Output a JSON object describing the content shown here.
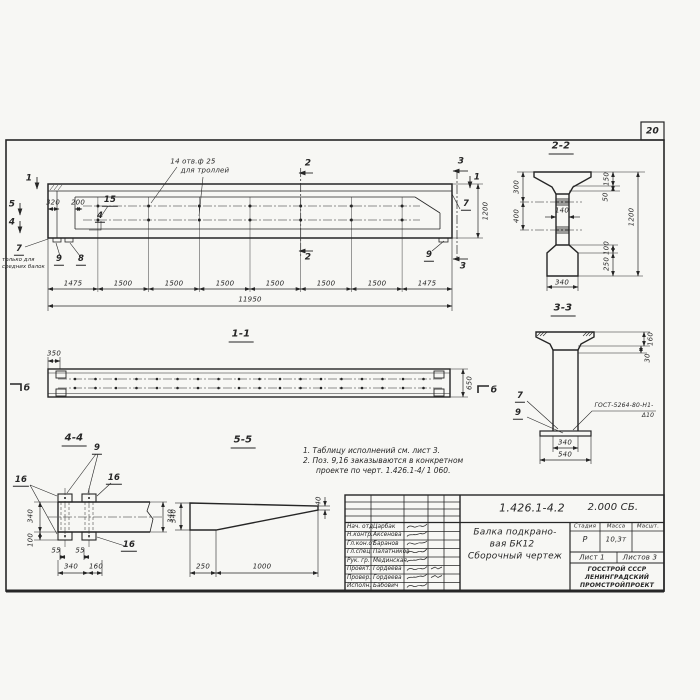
{
  "colors": {
    "paper": "#f7f7f4",
    "ink": "#262626"
  },
  "page": {
    "sheet_number": "20"
  },
  "main_view": {
    "holes_note_line1": "14 отв.ф 25",
    "holes_note_line2": "для троллей",
    "only_note_pos": "7",
    "only_note_line1": "только для",
    "only_note_line2": "средних балок",
    "marks": {
      "m1_left": "1",
      "m5": "5",
      "m4": "4",
      "m1_right": "1",
      "m2_top": "2",
      "m2_bottom": "2",
      "m3_top": "3",
      "m3_bottom": "3"
    },
    "positions": {
      "p15": "15",
      "p4": "4",
      "p9_left": "9",
      "p8": "8",
      "p9_right": "9",
      "p7_right": "7"
    },
    "dims": {
      "d320": "320",
      "d200": "200",
      "height": "1200",
      "segments": [
        "1475",
        "1500",
        "1500",
        "1500",
        "1500",
        "1500",
        "1500",
        "1475"
      ],
      "total": "11950"
    }
  },
  "section_2_2": {
    "label": "2-2",
    "dims": {
      "d300": "300",
      "d400": "400",
      "d140": "140",
      "d150": "150",
      "d50": "50",
      "d1200": "1200",
      "d100": "100",
      "d250": "250",
      "d340": "340"
    }
  },
  "section_3_3": {
    "label": "3-3",
    "weld_line1": "ГОСТ-5264-80-Н1-",
    "weld_line2": "Δ10",
    "positions": {
      "p7": "7",
      "p9": "9"
    },
    "dims": {
      "d160": "160",
      "d30": "30",
      "d340": "340",
      "d540": "540"
    }
  },
  "section_1_1": {
    "label": "1-1",
    "mark_left": "б",
    "mark_right": "б",
    "dims": {
      "d350": "350",
      "d650": "650"
    }
  },
  "detail_4_4": {
    "label": "4-4",
    "positions": {
      "p9": "9",
      "p16_left": "16",
      "p16_right": "16",
      "p16_bottom": "16"
    },
    "dims": {
      "d340_left": "340",
      "d100": "100",
      "d55_1": "55",
      "d55_2": "55",
      "d340_bottom": "340",
      "d160": "160",
      "d340_right": "340"
    }
  },
  "detail_5_5": {
    "label": "5-5",
    "dims": {
      "d340": "340",
      "d250": "250",
      "d1000": "1000",
      "d40": "40"
    }
  },
  "notes": {
    "line1": "1. Таблицу исполнений см. лист 3.",
    "line2": "2. Поз. 9,16 заказываются в конкретном",
    "line3": "проекте по черт. 1.426.1-4/ 1 060."
  },
  "title_block": {
    "doc_number": "1.426.1-4.2",
    "doc_suffix": "2.000 СБ.",
    "title_line1": "Балка подкрано-",
    "title_line2": "вая БК12",
    "title_line3": "Сборочный чертеж",
    "col_stage": "Стадия",
    "col_mass": "Масса",
    "col_scale": "Масшт.",
    "stage": "Р",
    "mass": "10,3т",
    "sheet": "Лист 1",
    "sheets": "Листов 3",
    "org_line1": "ГОССТРОЙ СССР",
    "org_line2": "ЛЕНИНГРАДСКИЙ",
    "org_line3": "ПРОМСТРОЙПРОЕКТ",
    "signature_rows": [
      {
        "role": "Нач. отд",
        "name": "Царбак"
      },
      {
        "role": "Н.контр.",
        "name": "Аксенова"
      },
      {
        "role": "Гл.кон.от",
        "name": "Баранов"
      },
      {
        "role": "Гл.спец.",
        "name": "Палатников"
      },
      {
        "role": "Рук. гр.",
        "name": "Мединская"
      },
      {
        "role": "Проект.",
        "name": "Гордеева"
      },
      {
        "role": "Провер.",
        "name": "Гордеева"
      },
      {
        "role": "Исполн.",
        "name": "Бабович"
      }
    ]
  }
}
